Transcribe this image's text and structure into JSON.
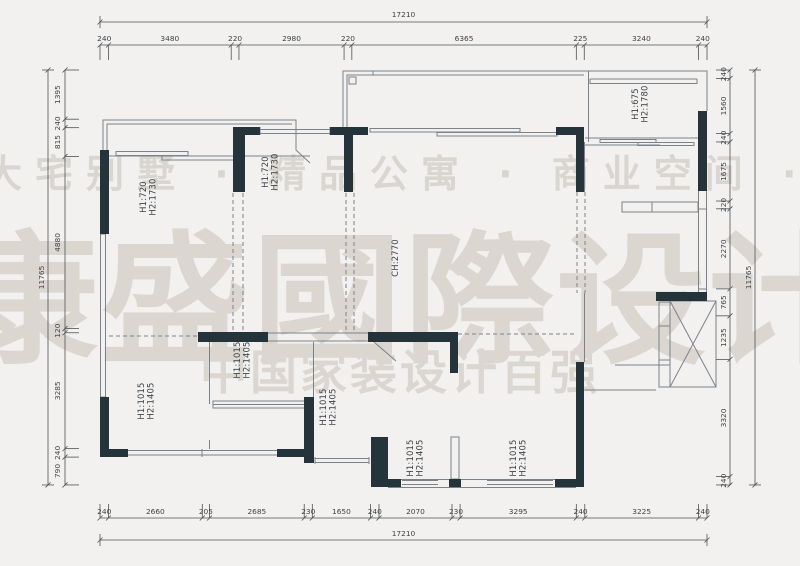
{
  "watermark": {
    "tagline": "大宅别墅 · 精品公寓 · 商业空间 · 设计装",
    "brand": "康盛國際设计",
    "subtitle": "中国家装设计百强"
  },
  "dimensions": {
    "top": {
      "total": "17210",
      "segments": [
        240,
        3480,
        220,
        2980,
        220,
        6365,
        225,
        3240,
        240
      ]
    },
    "bottom": {
      "total": "17210",
      "segments": [
        240,
        2660,
        205,
        2685,
        230,
        1650,
        240,
        2070,
        230,
        3295,
        240,
        3225,
        240
      ]
    },
    "left": {
      "total": "11765",
      "segments": [
        1395,
        240,
        815,
        4880,
        120,
        3285,
        240,
        790
      ]
    },
    "right": {
      "total": "11765",
      "segments": [
        240,
        1560,
        240,
        1675,
        220,
        2270,
        765,
        1235,
        3320,
        240
      ]
    }
  },
  "room_labels": [
    {
      "lines": [
        "H1:720",
        "H2:1730"
      ],
      "x": 146,
      "y": 197
    },
    {
      "lines": [
        "H1:720",
        "H2:1730"
      ],
      "x": 268,
      "y": 172
    },
    {
      "lines": [
        "H1:675",
        "H2:1780"
      ],
      "x": 638,
      "y": 104
    },
    {
      "lines": [
        "CH:2770"
      ],
      "x": 398,
      "y": 258
    },
    {
      "lines": [
        "H1:1015",
        "H2:1405"
      ],
      "x": 144,
      "y": 401
    },
    {
      "lines": [
        "H1:1015",
        "H2:1405"
      ],
      "x": 240,
      "y": 360
    },
    {
      "lines": [
        "H1:1015",
        "H2:1405"
      ],
      "x": 326,
      "y": 407
    },
    {
      "lines": [
        "H1:1015",
        "H2:1405"
      ],
      "x": 413,
      "y": 458
    },
    {
      "lines": [
        "H1:1015",
        "H2:1405"
      ],
      "x": 516,
      "y": 458
    }
  ],
  "colors": {
    "wall": "#24343a",
    "thin_line": "#7b838a",
    "dim_line": "#4d5357",
    "dim_text": "#3d4348",
    "label_text": "#3c434a",
    "watermark": "#dbd6d0",
    "background": "#f2f1ef"
  }
}
